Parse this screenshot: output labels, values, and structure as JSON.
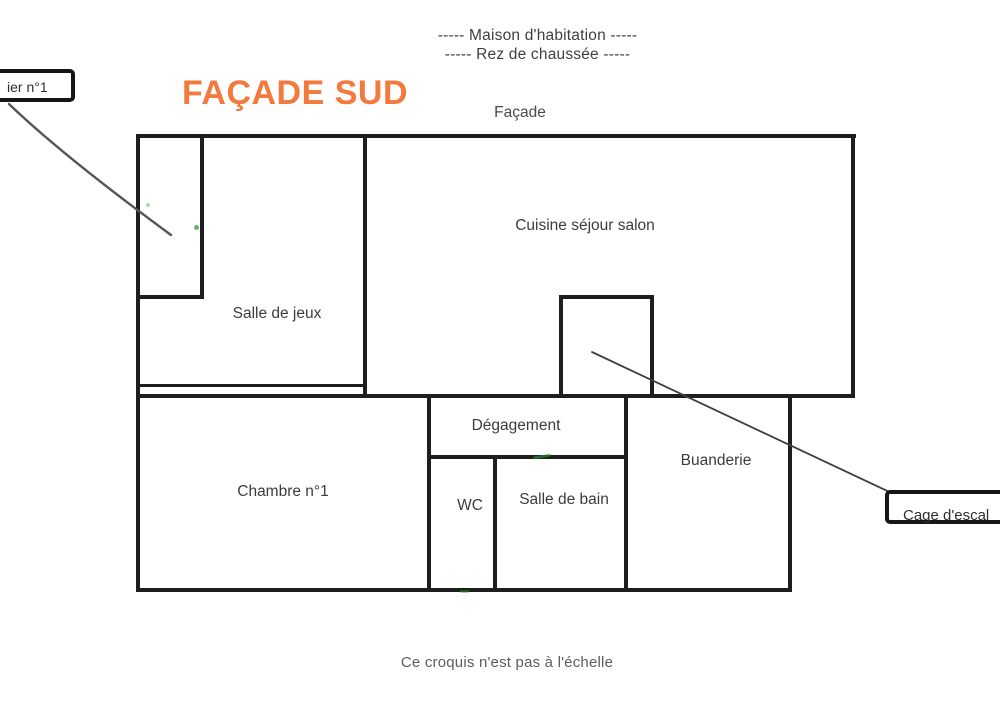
{
  "header": {
    "line1": "-----  Maison d'habitation  -----",
    "line2": "-----  Rez de chaussée  -----"
  },
  "title": "FAÇADE SUD",
  "facade_label": "Façade",
  "rooms": [
    {
      "id": "cuisine-sejour-salon",
      "label": "Cuisine séjour salon"
    },
    {
      "id": "salle-de-jeux",
      "label": "Salle de jeux"
    },
    {
      "id": "chambre-1",
      "label": "Chambre n°1"
    },
    {
      "id": "degagement",
      "label": "Dégagement"
    },
    {
      "id": "wc",
      "label": "WC"
    },
    {
      "id": "salle-de-bain",
      "label": "Salle de bain"
    },
    {
      "id": "buanderie",
      "label": "Buanderie"
    }
  ],
  "callouts": {
    "escalier": {
      "label": "ier n°1"
    },
    "cage": {
      "label": "Cage d'escal"
    }
  },
  "footnote": "Ce croquis n'est pas à l'échelle",
  "colors": {
    "accent_orange": "#f4793c",
    "wall": "#1e1e1e",
    "text": "#3d3d3d",
    "leader": "#4a4a4a",
    "green_mark": "#3a9a3a"
  }
}
